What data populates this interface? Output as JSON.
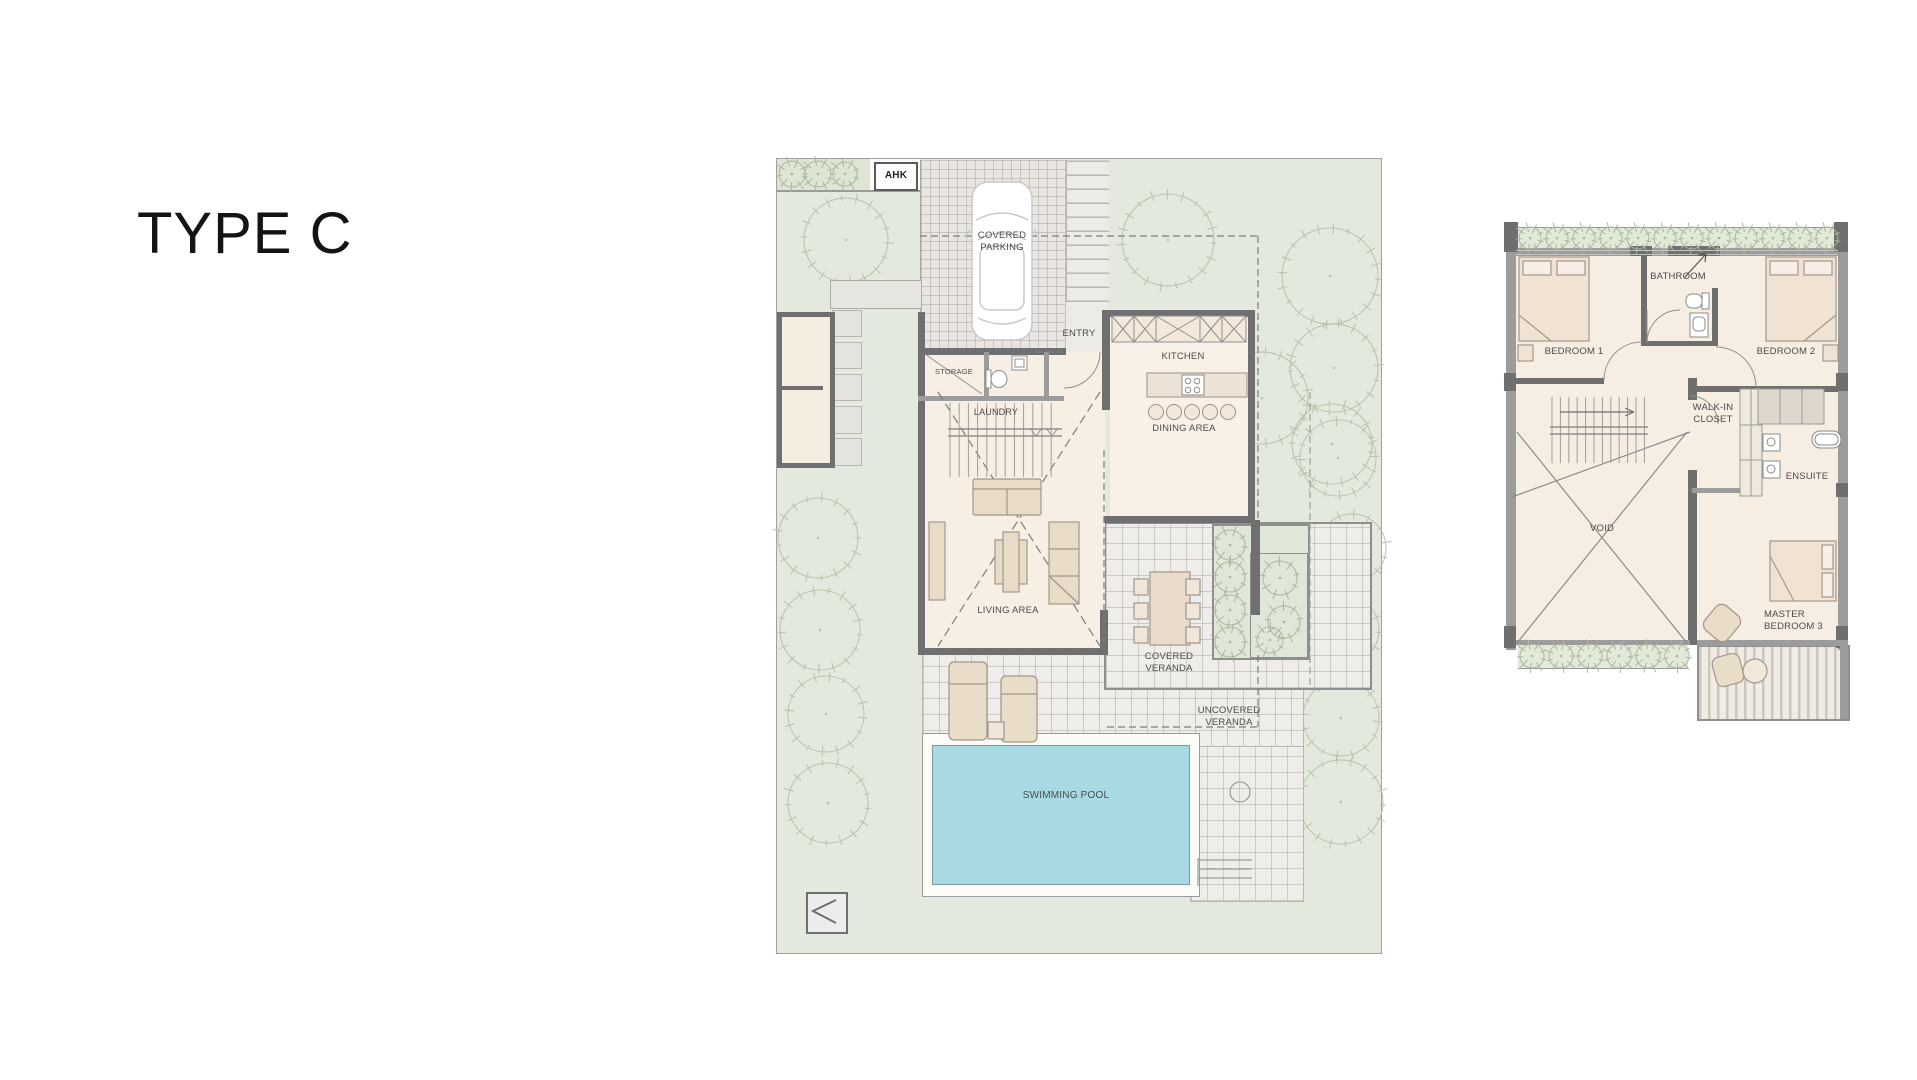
{
  "page": {
    "title": "TYPE C"
  },
  "colors": {
    "site_green": "#e3eadd",
    "hedge_green": "#dfe7d6",
    "room_beige": "#f8efe4",
    "pool_water": "#a8dae3",
    "wall_dark": "#6f6f6f",
    "tile_gray": "#eeedea",
    "label_gray": "#4a4a4a"
  },
  "ground_floor": {
    "labels": {
      "ahk": "AHK",
      "covered_parking": "COVERED PARKING",
      "entry": "ENTRY",
      "storage": "STORAGE",
      "laundry": "LAUNDRY",
      "kitchen": "KITCHEN",
      "dining_area": "DINING AREA",
      "living_area": "LIVING AREA",
      "covered_veranda": "COVERED VERANDA",
      "uncovered_veranda": "UNCOVERED VERANDA",
      "swimming_pool": "SWIMMING POOL"
    }
  },
  "first_floor": {
    "labels": {
      "bedroom_1": "BEDROOM 1",
      "bathroom": "BATHROOM",
      "bedroom_2": "BEDROOM 2",
      "walk_in_closet": "WALK-IN CLOSET",
      "ensuite": "ENSUITE",
      "void": "VOID",
      "master_bedroom_3": "MASTER BEDROOM 3"
    }
  }
}
